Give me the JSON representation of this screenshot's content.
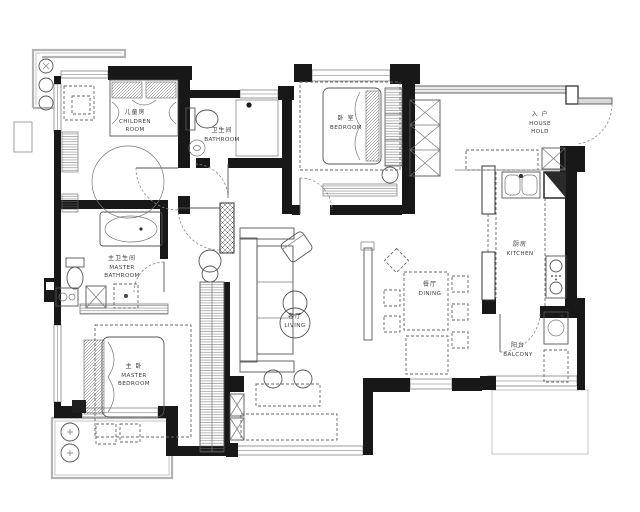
{
  "colors": {
    "wall": "#181818",
    "window": "#8f8f8f",
    "furniture_line": "#555555",
    "balcony_outline": "#b3b3b3",
    "label_text": "#3d3d3d"
  },
  "rooms": {
    "children_room": {
      "zh": "儿童房",
      "en1": "CHILDREN",
      "en2": "ROOM"
    },
    "bathroom": {
      "zh": "卫生间",
      "en1": "BATHROOM"
    },
    "bedroom": {
      "zh": "卧 室",
      "en1": "BEDROOM"
    },
    "household": {
      "zh": "入 户",
      "en1": "HOUSE",
      "en2": "HOLD"
    },
    "kitchen": {
      "zh": "厨房",
      "en1": "KITCHEN"
    },
    "dining": {
      "zh": "餐厅",
      "en1": "DINING"
    },
    "living": {
      "zh": "客厅",
      "en1": "LIVING"
    },
    "master_bathroom": {
      "zh": "主卫生间",
      "en1": "MASTER",
      "en2": "BATHROOM"
    },
    "master_bedroom": {
      "zh": "主 卧",
      "en1": "MASTER",
      "en2": "BEDROOM"
    },
    "balcony": {
      "zh": "阳台",
      "en1": "BALCONY"
    }
  }
}
